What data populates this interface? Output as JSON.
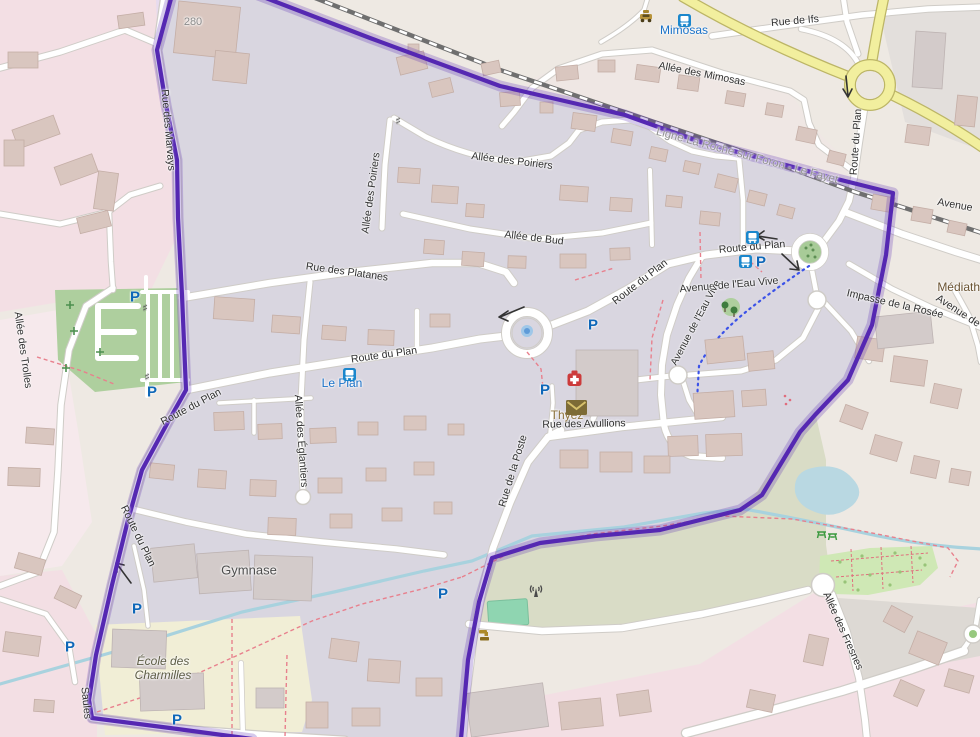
{
  "map": {
    "colors": {
      "boundary": "#5528b2",
      "primary_road": "#f2ef9e",
      "residential_inside": "#d9d6e0",
      "residential_pink": "#f3dfe4",
      "water": "#aad3df",
      "park_green": "#aecf9e",
      "school_yellow": "#f1eed6",
      "orchard_green": "#cfe8b5",
      "pitch_teal": "#8fd5b1"
    },
    "street_labels": [
      {
        "text": "Rue de Ifs"
      },
      {
        "text": "Allée des Mimosas"
      },
      {
        "text": "Rue des Marvays"
      },
      {
        "text": "Route du Plan"
      },
      {
        "text": "Avenue"
      },
      {
        "text": "Allée des Poiriers"
      },
      {
        "text": "Allée des Poiriers"
      },
      {
        "text": "Allée de Bud"
      },
      {
        "text": "Rue des Platanes"
      },
      {
        "text": "Route du Plan"
      },
      {
        "text": "Route du Plan"
      },
      {
        "text": "Avenue de l'Eau Vive"
      },
      {
        "text": "Avenue de l'Eau Vive"
      },
      {
        "text": "Impasse de la Rosée"
      },
      {
        "text": "Avenue de"
      },
      {
        "text": "Allée des Trolles"
      },
      {
        "text": "Route du Plan"
      },
      {
        "text": "Route du Plan"
      },
      {
        "text": "Rue des Avullions"
      },
      {
        "text": "Allée des Églantiers"
      },
      {
        "text": "Rue de la Poste"
      },
      {
        "text": "Route du Plan"
      },
      {
        "text": "Saules"
      },
      {
        "text": "Allée des Fresnes"
      }
    ],
    "transit_stops": [
      {
        "name": "Mimosas"
      },
      {
        "name": "Le Plan"
      }
    ],
    "poi_labels": [
      {
        "name": "Thyez"
      },
      {
        "name": "Gymnase"
      },
      {
        "name": "École des Charmilles"
      },
      {
        "name": "Médiathè"
      }
    ],
    "railway_label": "Ligne La Roche sur Foron - Le Fayet",
    "elevation_label": "280",
    "icons": {
      "parking_glyph": "P",
      "gate_glyph": "♯",
      "bus_stop": "bus-stop-icon",
      "taxi": "taxi-icon",
      "first_aid": "first-aid-icon",
      "post_box": "post-box-icon",
      "radio_mast": "radio-mast-icon",
      "water_tap": "water-tap-icon",
      "picnic_site": "picnic-site-icon",
      "fountain": "fountain-icon"
    }
  }
}
